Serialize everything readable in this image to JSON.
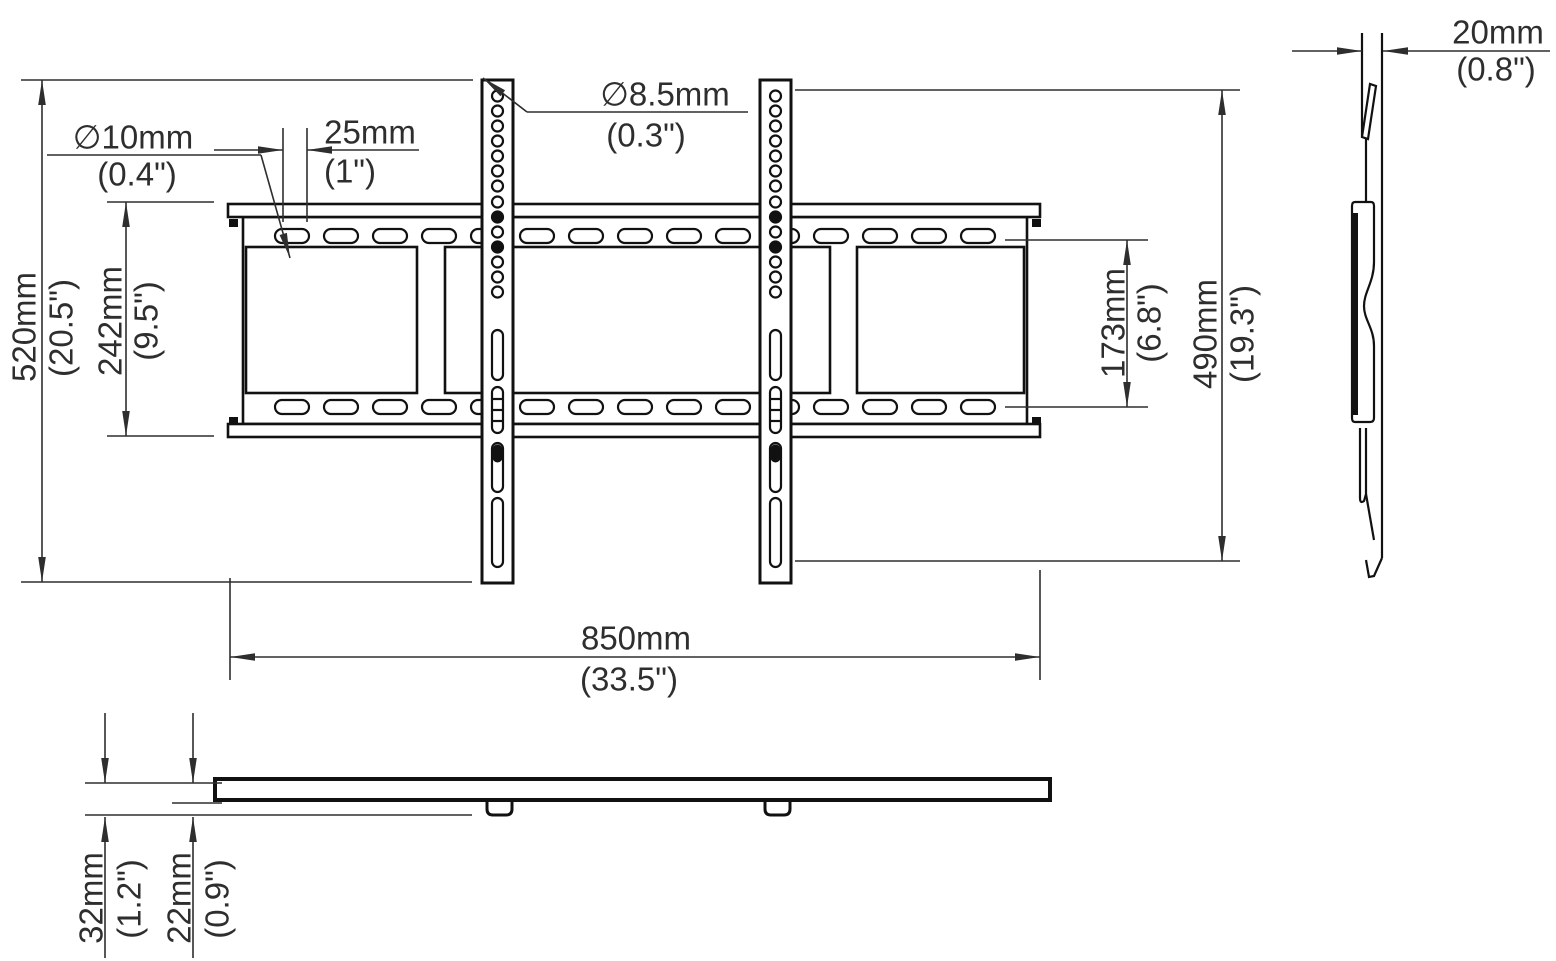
{
  "drawing": {
    "type": "tv-wall-mount-technical-drawing",
    "front_view": {
      "overall_height": {
        "metric": "520mm",
        "imperial": "(20.5\")"
      },
      "rail_height": {
        "metric": "242mm",
        "imperial": "(9.5\")"
      },
      "slot_hole_dia": {
        "metric": "∅10mm",
        "imperial": "(0.4\")"
      },
      "slot_pitch": {
        "metric": "25mm",
        "imperial": "(1\")"
      },
      "bracket_hole_dia": {
        "metric": "∅8.5mm",
        "imperial": "(0.3\")"
      },
      "slot_row_spacing": {
        "metric": "173mm",
        "imperial": "(6.8\")"
      },
      "bracket_height": {
        "metric": "490mm",
        "imperial": "(19.3\")"
      },
      "rail_width": {
        "metric": "850mm",
        "imperial": "(33.5\")"
      }
    },
    "side_view": {
      "profile_depth": {
        "metric": "20mm",
        "imperial": "(0.8\")"
      }
    },
    "bottom_view": {
      "overall_depth": {
        "metric": "32mm",
        "imperial": "(1.2\")"
      },
      "plate_offset": {
        "metric": "22mm",
        "imperial": "(0.9\")"
      }
    },
    "colors": {
      "line": "#111111",
      "dimension_line": "#2e2e2e",
      "text": "#2e2e2e",
      "background": "#ffffff"
    }
  }
}
